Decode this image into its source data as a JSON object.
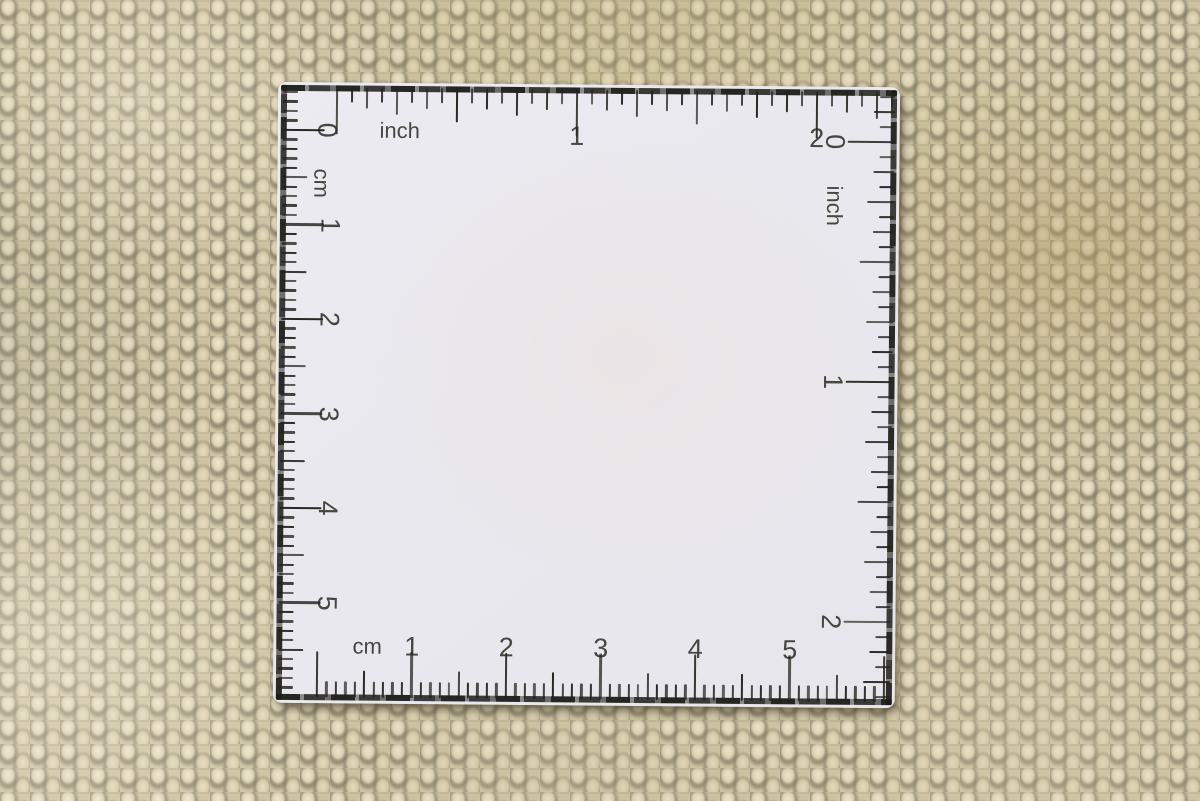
{
  "colors": {
    "ink": "#23221d",
    "card": "#e9e9ee",
    "carpet_base": "#cdc2a2"
  },
  "ruler_card": {
    "top_scale": {
      "unit_label": "inch",
      "numbers": [
        "1",
        "2"
      ]
    },
    "left_scale": {
      "unit_label": "cm",
      "zero_label": "0",
      "numbers": [
        "1",
        "2",
        "3",
        "4",
        "5"
      ]
    },
    "right_scale": {
      "unit_label": "inch",
      "numbers": [
        "0",
        "1",
        "2"
      ]
    },
    "bottom_scale": {
      "unit_label": "cm",
      "numbers": [
        "1",
        "2",
        "3",
        "4",
        "5"
      ]
    }
  }
}
